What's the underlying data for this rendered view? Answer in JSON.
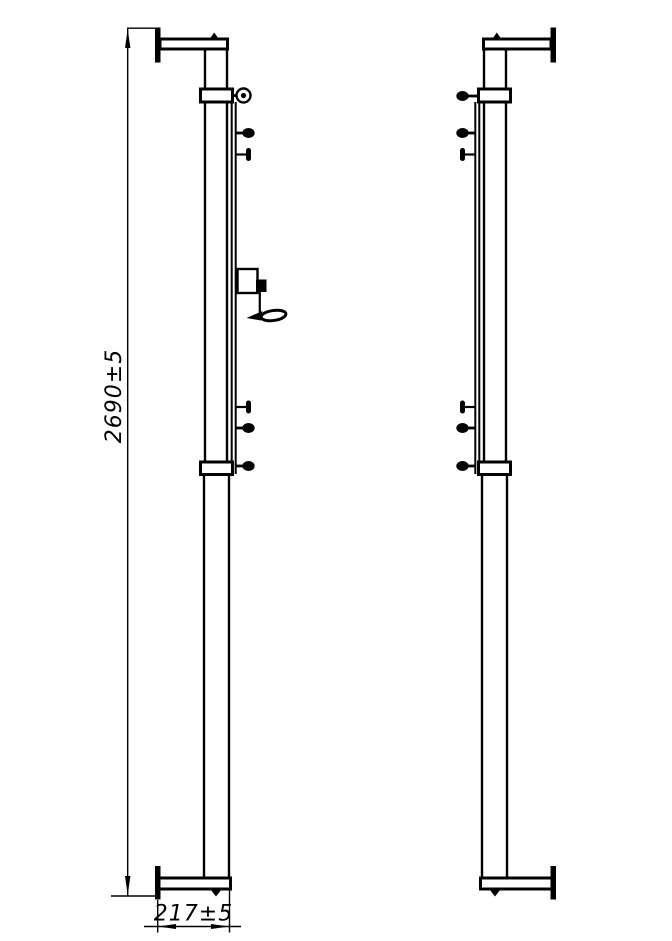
{
  "drawing": {
    "dimensions": {
      "height_label": "2690±5",
      "width_label": "217±5"
    },
    "colors": {
      "ink": "#000000",
      "background": "#ffffff"
    }
  }
}
